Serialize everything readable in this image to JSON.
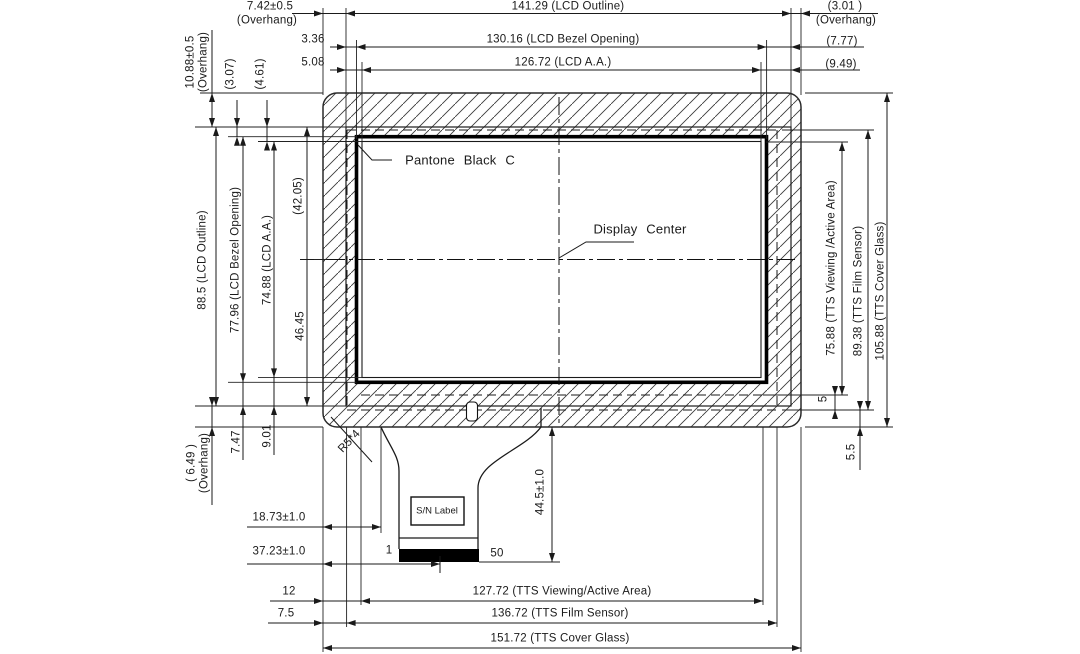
{
  "annotations": {
    "pantone_black": "Pantone Black C",
    "display_center": "Display Center",
    "sn_label": "S/N Label",
    "pin_first": "1",
    "pin_last": "50",
    "corner_radius": "R5*4"
  },
  "dims_top": {
    "overhang_left": "7.42±0.5",
    "overhang_left_note": "(Overhang)",
    "lcd_outline_width": "141.29 (LCD Outline)",
    "overhang_right": "(3.01 )",
    "overhang_right_note": "(Overhang)",
    "bezel_offset_left": "3.36",
    "bezel_opening_width": "130.16 (LCD Bezel Opening)",
    "bezel_offset_right": "(7.77)",
    "aa_offset_left": "5.08",
    "aa_width": "126.72 (LCD A.A.)",
    "aa_offset_right": "(9.49)"
  },
  "dims_left": {
    "overhang_top": "10.88±0.5",
    "overhang_top_note": "(Overhang)",
    "bezel_offset_top": "(3.07)",
    "aa_offset_top": "(4.61)",
    "lcd_outline_height": "88.5 (LCD Outline)",
    "bezel_opening_height": "77.96 (LCD Bezel Opening)",
    "aa_height": "74.88 (LCD A.A.)",
    "center_to_top": "(42.05)",
    "center_to_bottom": "46.45",
    "overhang_bottom": "( 6.49 )",
    "overhang_bottom_note": "(Overhang)",
    "bezel_offset_bottom": "7.47",
    "aa_offset_bottom": "9.01"
  },
  "dims_right": {
    "tts_viewing_height": "75.88 (TTS Viewing /Active Area)",
    "tts_film_height": "89.38 (TTS Film Sensor)",
    "tts_glass_height": "105.88 (TTS Cover Glass)",
    "viewing_to_film": "5",
    "film_to_glass": "5.5"
  },
  "dims_bottom": {
    "fpc_offset": "18.73±1.0",
    "connector_offset": "37.23±1.0",
    "fpc_length": "44.5±1.0",
    "viewing_offset_left": "12",
    "tts_viewing_width": "127.72 (TTS Viewing/Active Area)",
    "film_offset_left": "7.5",
    "tts_film_width": "136.72 (TTS Film Sensor)",
    "tts_glass_width": "151.72 (TTS Cover Glass)"
  },
  "colors": {
    "line": "#1a1a1a",
    "background": "#ffffff",
    "connector_fill": "#000000",
    "hatch": "#3a3a3a"
  }
}
